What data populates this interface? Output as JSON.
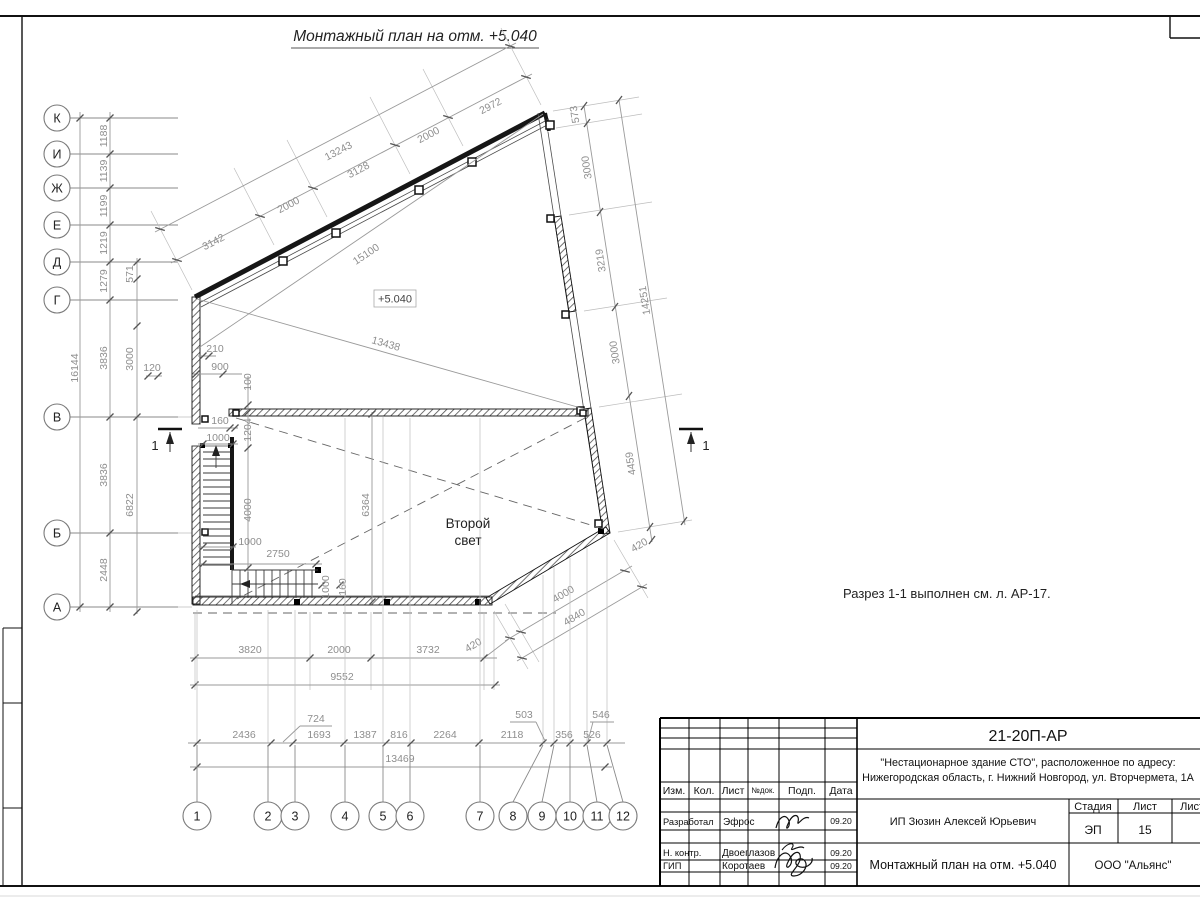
{
  "sheet": {
    "heading": "Монтажный план на отм. +5.040",
    "note": "Разрез 1-1 выполнен см. л. АР-17.",
    "elevation_mark": "+5.040",
    "void_line1": "Второй",
    "void_line2": "свет",
    "section_left": "1",
    "section_right": "1"
  },
  "grid": {
    "rows": [
      "К",
      "И",
      "Ж",
      "Е",
      "Д",
      "Г",
      "В",
      "Б",
      "А"
    ],
    "cols": [
      "1",
      "2",
      "3",
      "4",
      "5",
      "6",
      "7",
      "8",
      "9",
      "10",
      "11",
      "12"
    ]
  },
  "dims": {
    "top": [
      "3142",
      "2000",
      "3128",
      "2000",
      "2972"
    ],
    "top_total": "13243",
    "diag_upper": "15100",
    "diag_lower": "13438",
    "right": [
      "573",
      "3000",
      "3219",
      "3000",
      "4459"
    ],
    "right_total": "14251",
    "right_420": "420",
    "angled_420": "420",
    "angled_4000": "4000",
    "angled_total": "4840",
    "left": [
      "1188",
      "1139",
      "1199",
      "1219",
      "1279",
      "3836",
      "3836",
      "2448"
    ],
    "left_total": "16144",
    "left_571": "571",
    "left_3000": "3000",
    "left_120": "120",
    "left_6822": "6822",
    "s210": "210",
    "s900": "900",
    "s100": "100",
    "s160a": "160",
    "s1000a": "1000",
    "s1204": "1204",
    "s4000": "4000",
    "s1000b": "1000",
    "s2750": "2750",
    "s1000c": "1000",
    "s160b": "160",
    "s6364": "6364",
    "bottom": [
      "3820",
      "2000",
      "3732"
    ],
    "bottom_420": "420",
    "bottom_total": "9552",
    "chain": [
      "2436",
      "724",
      "1693",
      "1387",
      "816",
      "2264",
      "2118",
      "503",
      "356",
      "526",
      "546"
    ],
    "chain_total": "13469"
  },
  "title_block": {
    "doc_no": "21-20П-АР",
    "project1": "\"Нестационарное здание СТО\", расположенное по адресу:",
    "project2": "Нижегородская область, г. Нижний Новгород, ул. Вторчермета, 1А",
    "col_izm": "Изм.",
    "col_kol": "Кол.",
    "col_list": "Лист",
    "col_ndok": "№док.",
    "col_podp": "Подп.",
    "col_data": "Дата",
    "row1_role": "Разработал",
    "row1_name": "Эфрос",
    "row1_date": "09.20",
    "row2_role": "Н. контр.",
    "row2_name": "Двоеглазов",
    "row2_date": "09.20",
    "row3_role": "ГИП",
    "row3_name": "Коротаев",
    "row3_date": "09.20",
    "client": "ИП Зюзин Алексей Юрьевич",
    "stage_label": "Стадия",
    "list_label": "Лист",
    "listov_label": "Листов",
    "stage": "ЭП",
    "sheet_no": "15",
    "drawing_name": "Монтажный план на отм. +5.040",
    "company": "ООО \"Альянс\""
  }
}
